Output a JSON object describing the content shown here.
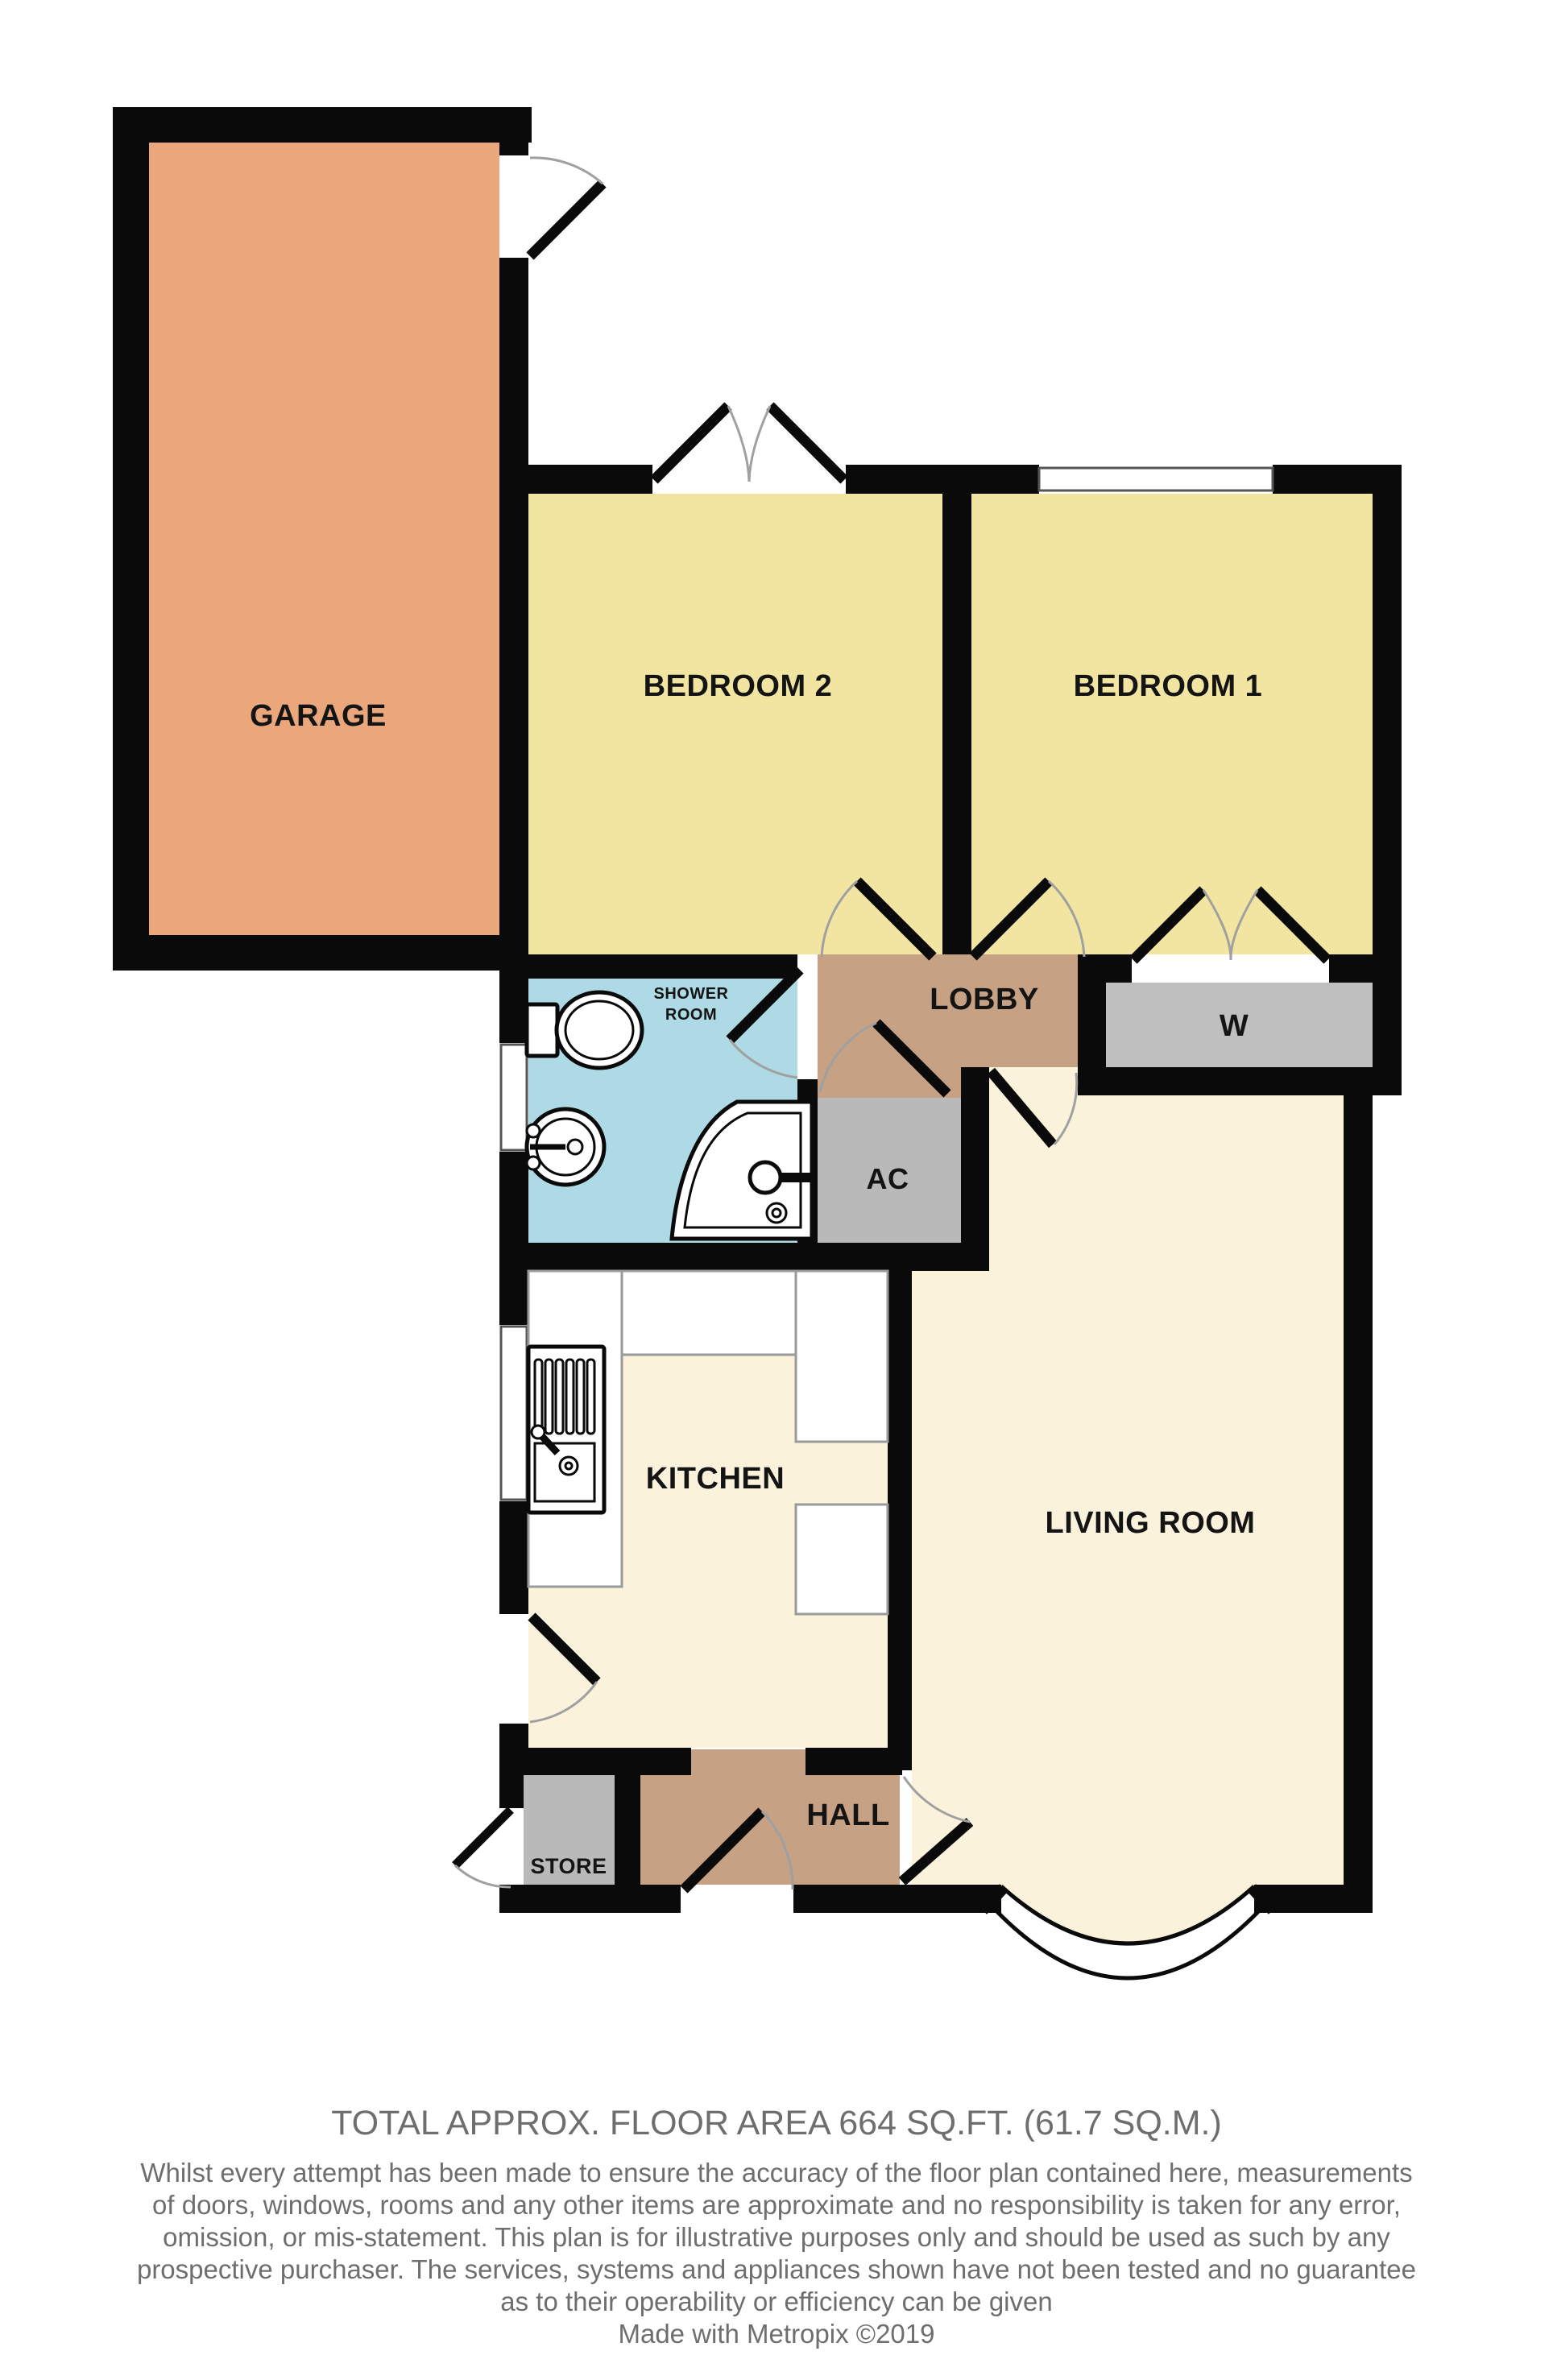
{
  "plan": {
    "colors": {
      "wall": "#0a0a0a",
      "cream": "#FBF2DC",
      "door_arc": "#a0a0a0",
      "window_fill": "#ffffff"
    },
    "rooms": [
      {
        "id": "garage",
        "label": "GARAGE",
        "color": "#EAA77C"
      },
      {
        "id": "bedroom-2",
        "label": "BEDROOM 2",
        "color": "#F2E5A1"
      },
      {
        "id": "bedroom-1",
        "label": "BEDROOM 1",
        "color": "#F2E5A1"
      },
      {
        "id": "shower-room",
        "label": "SHOWER",
        "label2": "ROOM",
        "color": "#AEDAE6"
      },
      {
        "id": "lobby",
        "label": "LOBBY",
        "color": "#C7A184"
      },
      {
        "id": "wardrobe",
        "label": "W",
        "color": "#BFBFBF"
      },
      {
        "id": "ac",
        "label": "AC",
        "color": "#B9B9B9"
      },
      {
        "id": "kitchen",
        "label": "KITCHEN",
        "color": "#FBF2DC"
      },
      {
        "id": "living-room",
        "label": "LIVING ROOM",
        "color": "#FBF2DC"
      },
      {
        "id": "store",
        "label": "STORE",
        "color": "#B9B9B9"
      },
      {
        "id": "hall",
        "label": "HALL",
        "color": "#C7A184"
      }
    ]
  },
  "footer": {
    "area_line": "TOTAL APPROX. FLOOR AREA 664 SQ.FT. (61.7 SQ.M.)",
    "disclaimer_lines": [
      "Whilst every attempt has been made to ensure the accuracy of the floor plan contained here, measurements",
      "of doors, windows, rooms and any other items are approximate and no responsibility is taken for any error,",
      "omission, or mis-statement. This plan is for illustrative purposes only and should be used as such by any",
      "prospective purchaser. The services, systems and appliances shown have not been tested and no guarantee",
      "as to their operability or efficiency can be given"
    ],
    "credit": "Made with Metropix ©2019"
  }
}
